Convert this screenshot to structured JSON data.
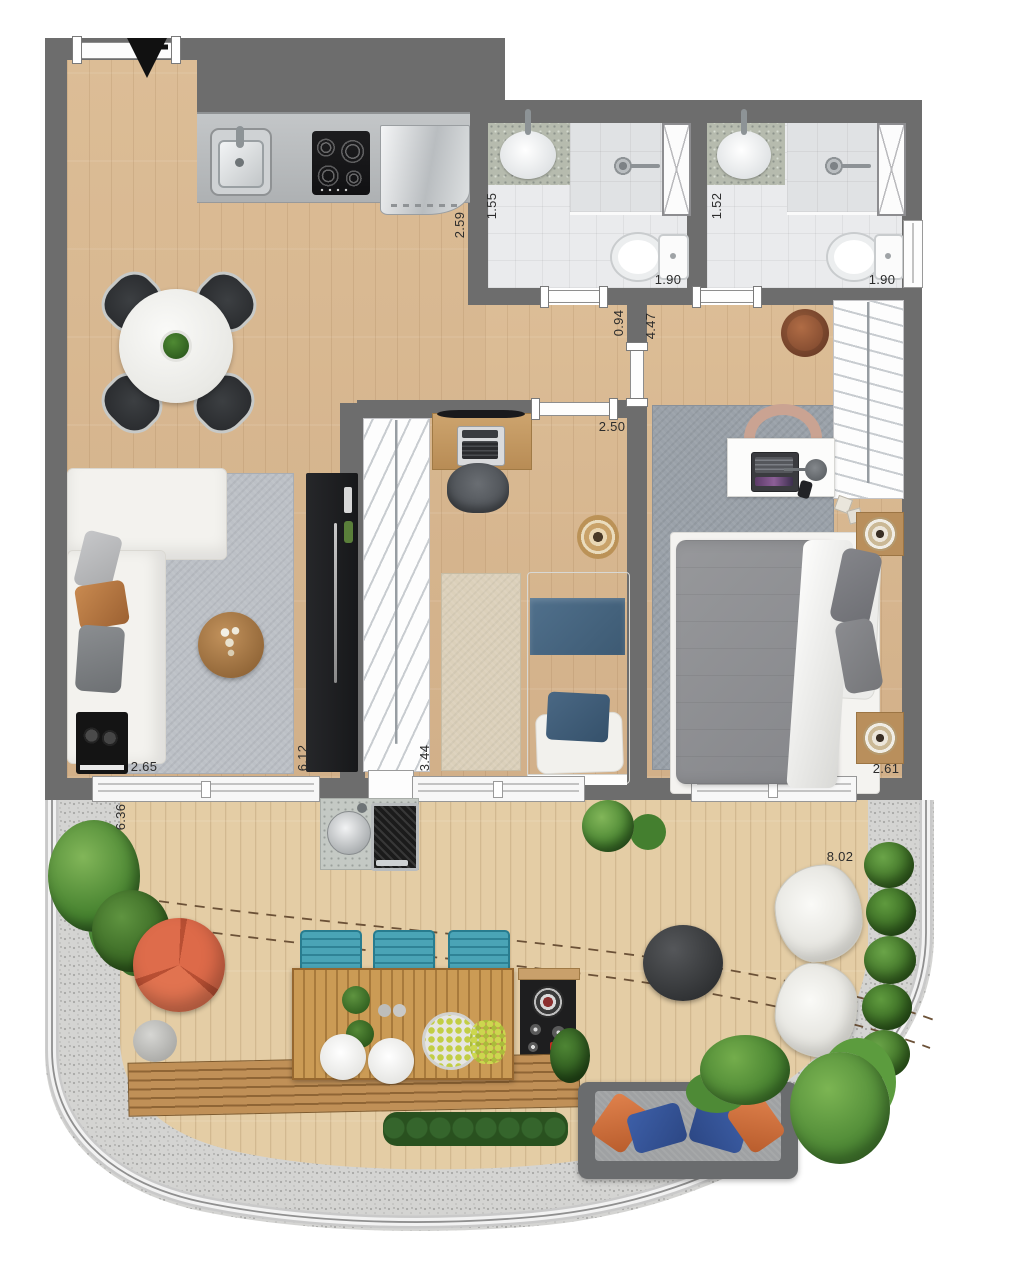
{
  "plan": {
    "type": "apartment-floor-plan-top-view",
    "dimension_labels": {
      "kitchen_counter": "2.59",
      "bath1_width": "1.55",
      "bath1_length": "1.90",
      "bath2_width": "1.52",
      "bath2_length": "1.90",
      "hall_passage": "0.94",
      "bedroom2_length": "4.47",
      "bedroom1_entry": "2.50",
      "living_side": "2.65",
      "living_length": "6.12",
      "bedroom1_side": "3.44",
      "bedroom2_width": "2.61",
      "terrace_side": "6.36",
      "terrace_width": "8.02"
    },
    "colors": {
      "wall": "#6d6d6d",
      "floor_wood": "#d7b68e",
      "deck_wood": "#e4cda5",
      "tile": "#eaebed",
      "rug_gray": "#bcc0c6",
      "accent_orange": "#dd6a49",
      "accent_teal": "#3f9ab0",
      "accent_navy": "#46637c",
      "plant_green": "#46822f"
    }
  }
}
